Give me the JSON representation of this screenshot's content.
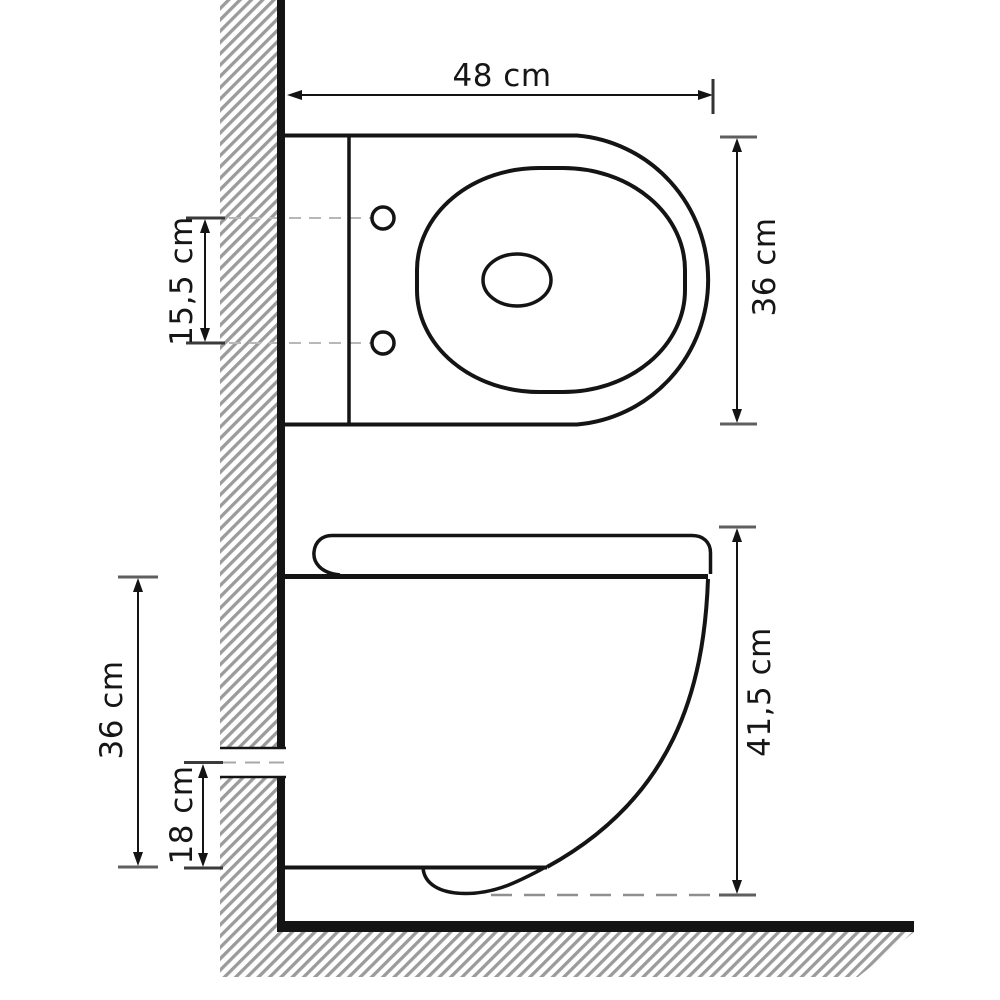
{
  "diagram": {
    "unit": "cm",
    "colors": {
      "line": "#141414",
      "tick": "#4f4f4f",
      "hatch": "#9b9b9b",
      "dash_light": "#b8b8b8",
      "dash_dark": "#8f8f8f",
      "background": "#ffffff"
    },
    "top_view": {
      "dimensions": {
        "width": {
          "label": "48 cm",
          "value": 48
        },
        "depth": {
          "label": "36 cm",
          "value": 36
        },
        "hole_spacing": {
          "label": "15,5 cm",
          "value": 15.5
        }
      }
    },
    "side_view": {
      "dimensions": {
        "total_height": {
          "label": "41,5 cm",
          "value": 41.5
        },
        "body_height": {
          "label": "36 cm",
          "value": 36
        },
        "inlet_height": {
          "label": "18 cm",
          "value": 18
        }
      }
    }
  }
}
